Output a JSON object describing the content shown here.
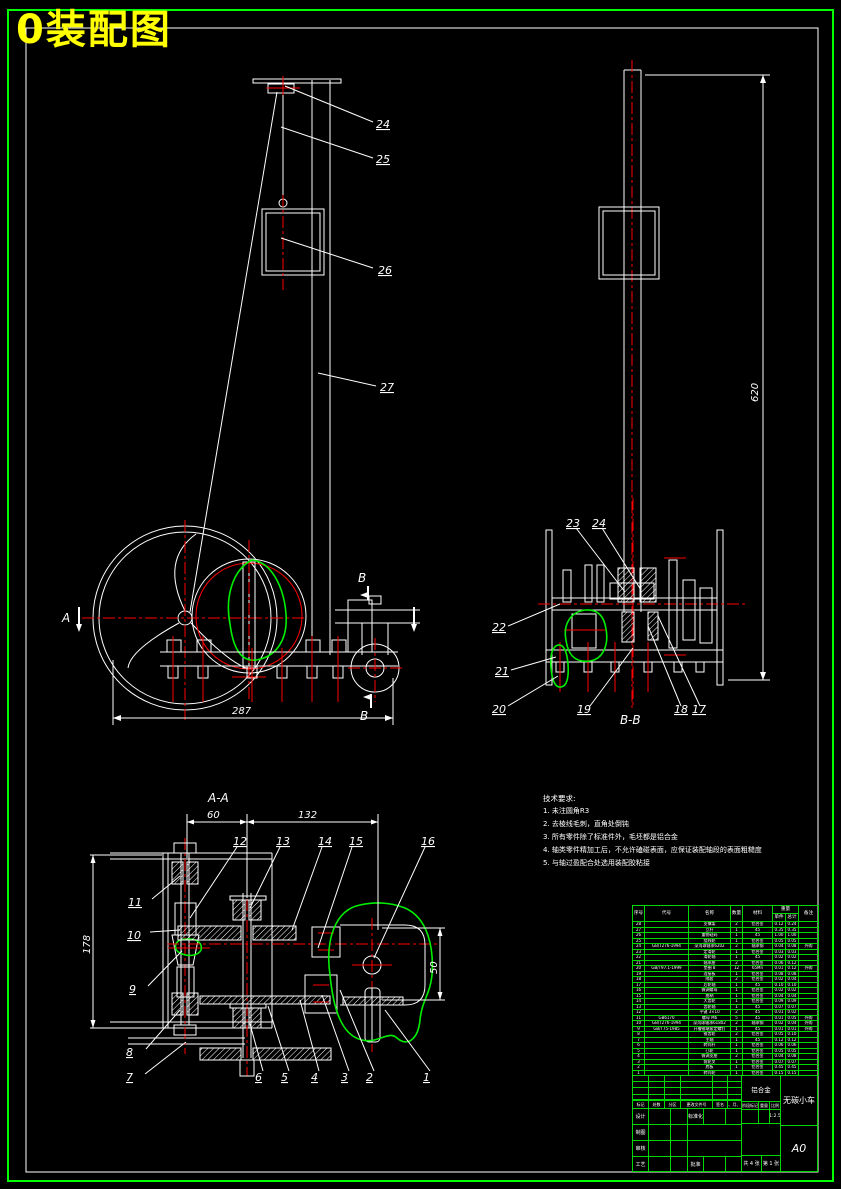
{
  "page": {
    "title": "0装配图",
    "colors": {
      "background": "#000000",
      "frame_green": "#00ff00",
      "line_white": "#ffffff",
      "centerline_red": "#ff0000",
      "highlight_green": "#00ee00",
      "title_yellow": "#ffff00",
      "table_green": "#00d900"
    }
  },
  "front": {
    "p24": "24",
    "p25": "25",
    "p26": "26",
    "p27": "27",
    "dim_width": "287",
    "sec_a": "A",
    "sec_b_top": "B",
    "sec_b_bot": "B"
  },
  "side": {
    "dim_height": "620"
  },
  "bb": {
    "caption": "B-B",
    "p17": "17",
    "p18": "18",
    "p19": "19",
    "p20": "20",
    "p21": "21",
    "p22": "22",
    "p23": "23",
    "p24": "24"
  },
  "aa": {
    "caption": "A-A",
    "d60": "60",
    "d132": "132",
    "d178": "178",
    "d50": "50",
    "p1": "1",
    "p2": "2",
    "p3": "3",
    "p4": "4",
    "p5": "5",
    "p6": "6",
    "p7": "7",
    "p8": "8",
    "p9": "9",
    "p10": "10",
    "p11": "11",
    "p12": "12",
    "p13": "13",
    "p14": "14",
    "p15": "15",
    "p16": "16"
  },
  "notes": {
    "title": "技术要求:",
    "lines": [
      "1. 未注圆角R3",
      "2. 去棱线毛刺，直角处倒钝",
      "3. 所有零件除了标准件外，毛坯都是铝合金",
      "4. 轴类零件精加工后，不允许磕碰表面，应保证装配轴段的表面粗糙度",
      "5. 与轴过盈配合处选用装配胶粘接"
    ]
  },
  "bom": {
    "headers": {
      "no": "序号",
      "code": "代号",
      "name": "名称",
      "qty": "数量",
      "material": "材料",
      "weight": "重量",
      "unit": "单件",
      "total": "总计",
      "note": "备注"
    },
    "rows": [
      {
        "no": "28",
        "code": "",
        "name": "支撑架",
        "qty": "2",
        "material": "铝合金",
        "unit": "0.12",
        "total": "0.24",
        "note": ""
      },
      {
        "no": "27",
        "code": "",
        "name": "立杆",
        "qty": "1",
        "material": "45",
        "unit": "0.35",
        "total": "0.35",
        "note": ""
      },
      {
        "no": "26",
        "code": "",
        "name": "重物砝码",
        "qty": "1",
        "material": "45",
        "unit": "1.00",
        "total": "1.00",
        "note": ""
      },
      {
        "no": "25",
        "code": "",
        "name": "绕线轮",
        "qty": "1",
        "material": "铝合金",
        "unit": "0.05",
        "total": "0.05",
        "note": ""
      },
      {
        "no": "24",
        "code": "GB/T276-1994",
        "name": "深沟球轴承6202",
        "qty": "2",
        "material": "轴承钢",
        "unit": "0.04",
        "total": "0.08",
        "note": "外购"
      },
      {
        "no": "23",
        "code": "",
        "name": "定滑轮",
        "qty": "1",
        "material": "铝合金",
        "unit": "0.03",
        "total": "0.03",
        "note": ""
      },
      {
        "no": "22",
        "code": "",
        "name": "滑轮轴",
        "qty": "1",
        "material": "45",
        "unit": "0.02",
        "total": "0.02",
        "note": ""
      },
      {
        "no": "21",
        "code": "",
        "name": "轴承座",
        "qty": "2",
        "material": "铝合金",
        "unit": "0.06",
        "total": "0.12",
        "note": ""
      },
      {
        "no": "20",
        "code": "GB/T97.1-1999",
        "name": "垫圈 8",
        "qty": "12",
        "material": "65Mn",
        "unit": "0.01",
        "total": "0.12",
        "note": "外购"
      },
      {
        "no": "19",
        "code": "",
        "name": "连接板",
        "qty": "1",
        "material": "铝合金",
        "unit": "0.08",
        "total": "0.08",
        "note": ""
      },
      {
        "no": "18",
        "code": "",
        "name": "隔套",
        "qty": "2",
        "material": "铝合金",
        "unit": "0.02",
        "total": "0.04",
        "note": ""
      },
      {
        "no": "17",
        "code": "",
        "name": "后轮轴",
        "qty": "1",
        "material": "45",
        "unit": "0.10",
        "total": "0.10",
        "note": ""
      },
      {
        "no": "16",
        "code": "",
        "name": "微调螺母",
        "qty": "1",
        "material": "铝合金",
        "unit": "0.02",
        "total": "0.02",
        "note": ""
      },
      {
        "no": "15",
        "code": "",
        "name": "曲柄",
        "qty": "1",
        "material": "铝合金",
        "unit": "0.04",
        "total": "0.04",
        "note": ""
      },
      {
        "no": "14",
        "code": "",
        "name": "大齿轮",
        "qty": "1",
        "material": "铝合金",
        "unit": "0.09",
        "total": "0.09",
        "note": ""
      },
      {
        "no": "13",
        "code": "",
        "name": "齿轮轴",
        "qty": "1",
        "material": "45",
        "unit": "0.07",
        "total": "0.07",
        "note": ""
      },
      {
        "no": "12",
        "code": "",
        "name": "平键 3×10",
        "qty": "2",
        "material": "45",
        "unit": "0.01",
        "total": "0.02",
        "note": ""
      },
      {
        "no": "11",
        "code": "GB6170",
        "name": "螺母 M6",
        "qty": "5",
        "material": "45",
        "unit": "0.01",
        "total": "0.05",
        "note": "外购"
      },
      {
        "no": "10",
        "code": "GB/T276-1994",
        "name": "深沟球轴承61802",
        "qty": "2",
        "material": "轴承钢",
        "unit": "0.02",
        "total": "0.04",
        "note": "外购"
      },
      {
        "no": "9",
        "code": "GB/T75-1985",
        "name": "开槽锥端紧定螺钉",
        "qty": "1",
        "material": "45",
        "unit": "0.01",
        "total": "0.01",
        "note": "外购"
      },
      {
        "no": "8",
        "code": "",
        "name": "锥齿轮",
        "qty": "2",
        "material": "铝合金",
        "unit": "0.05",
        "total": "0.10",
        "note": ""
      },
      {
        "no": "7",
        "code": "",
        "name": "主轴",
        "qty": "1",
        "material": "45",
        "unit": "0.12",
        "total": "0.12",
        "note": ""
      },
      {
        "no": "6",
        "code": "",
        "name": "转向杆",
        "qty": "1",
        "material": "铝合金",
        "unit": "0.06",
        "total": "0.06",
        "note": ""
      },
      {
        "no": "5",
        "code": "",
        "name": "凸轮",
        "qty": "1",
        "material": "铝合金",
        "unit": "0.05",
        "total": "0.05",
        "note": ""
      },
      {
        "no": "4",
        "code": "",
        "name": "微调支座",
        "qty": "2",
        "material": "铝合金",
        "unit": "0.04",
        "total": "0.08",
        "note": ""
      },
      {
        "no": "3",
        "code": "",
        "name": "前轮叉",
        "qty": "1",
        "material": "铝合金",
        "unit": "0.07",
        "total": "0.07",
        "note": ""
      },
      {
        "no": "2",
        "code": "",
        "name": "底板",
        "qty": "1",
        "material": "铝合金",
        "unit": "0.45",
        "total": "0.45",
        "note": ""
      },
      {
        "no": "1",
        "code": "",
        "name": "转向轮",
        "qty": "1",
        "material": "铝合金",
        "unit": "0.15",
        "total": "0.15",
        "note": ""
      }
    ]
  },
  "tb": {
    "material": "铝合金",
    "product": "无碳小车",
    "sheet": "A0",
    "scale_value": "1:2.5",
    "sheets": "共 4 张",
    "sheetno": "第 1 张",
    "labels": {
      "mark": "标记",
      "count": "处数",
      "zone": "分区",
      "doc": "更改文件号",
      "sign": "签名",
      "date": "年、月、日",
      "design": "设计",
      "draw": "制图",
      "check": "审核",
      "process": "工艺",
      "standard": "标准化",
      "approve": "批准",
      "stage": "阶段标记",
      "weight": "重量",
      "scale": "比例"
    }
  }
}
